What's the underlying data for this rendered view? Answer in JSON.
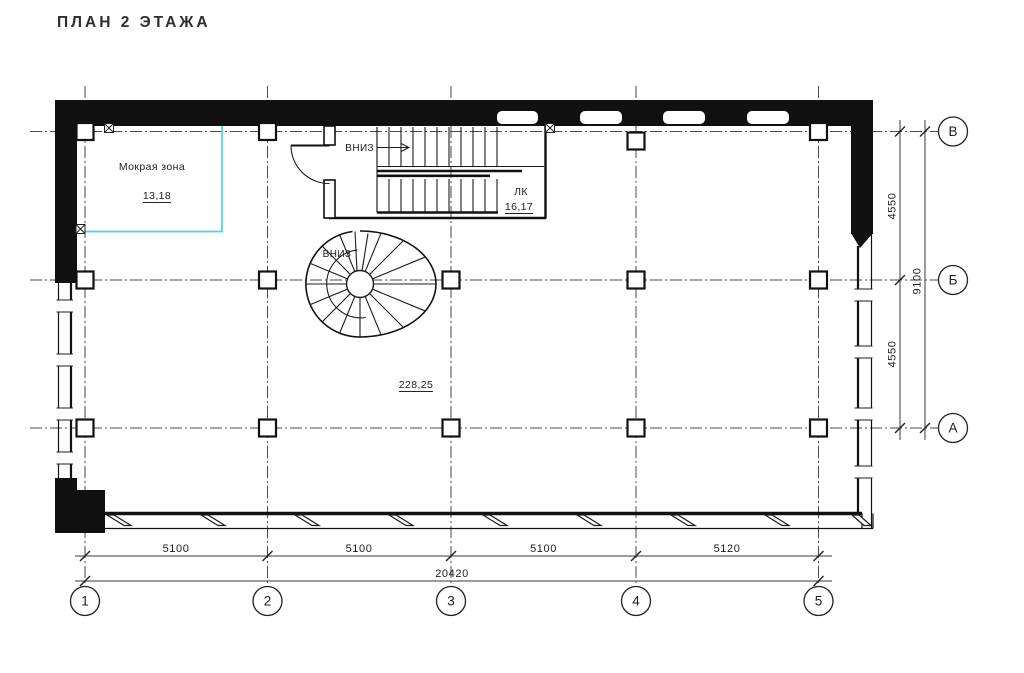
{
  "title": "ПЛАН 2 ЭТАЖА",
  "rooms": {
    "wet_zone": {
      "name": "Мокрая зона",
      "area": "13,18"
    },
    "stairwell": {
      "name": "ЛК",
      "area": "16,17"
    },
    "hall": {
      "area": "228,25"
    }
  },
  "stairs": {
    "straight_down_label": "ВНИЗ",
    "spiral_down_label": "ВНИЗ"
  },
  "axes": {
    "vertical": [
      "1",
      "2",
      "3",
      "4",
      "5"
    ],
    "horizontal": [
      "В",
      "Б",
      "А"
    ]
  },
  "dims": {
    "bottom": [
      "5100",
      "5100",
      "5100",
      "5120"
    ],
    "bottom_total": "20420",
    "right": [
      "4550",
      "4550"
    ],
    "right_total": "9100"
  },
  "colors": {
    "wet_zone_outline": "#4ed3da",
    "drawing_line": "#161616"
  }
}
